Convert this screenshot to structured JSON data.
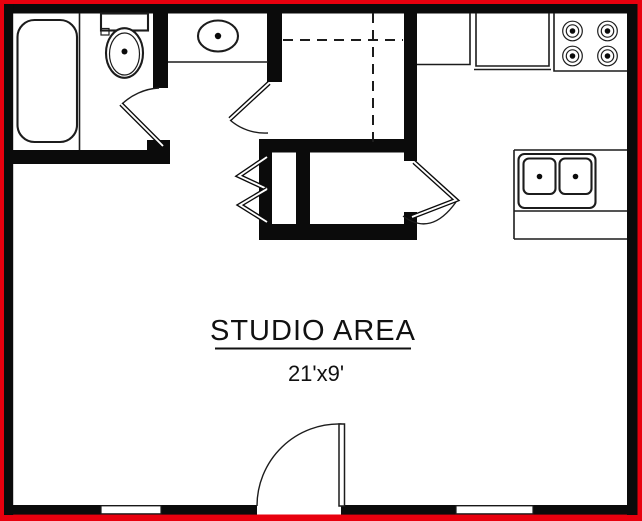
{
  "colors": {
    "red": "#e8000e",
    "wall": "#0b0b0b",
    "floor": "#ffffff",
    "line": "#1c1c1c"
  },
  "rooms": {
    "studio": {
      "label": "STUDIO AREA",
      "dimensions": "21'x9'"
    }
  },
  "fixtures": {
    "bathtub": "bathtub-icon",
    "toilet": "toilet-icon",
    "vanity_sink": "vanity-sink-icon",
    "stove": "stove-burners-icon",
    "kitchen_counter": "kitchen-counter-icon",
    "kitchen_sink": "double-basin-sink-icon",
    "bathroom_door": "swing-door-icon",
    "vanity_closet_door": "swing-door-icon",
    "bifold_closet_doors": "bifold-door-icon",
    "closet_door": "double-swing-door-icon",
    "closet_shelving": "dashed-shelf-lines",
    "entry_door": "swing-door-icon",
    "windows": "window-icon"
  }
}
